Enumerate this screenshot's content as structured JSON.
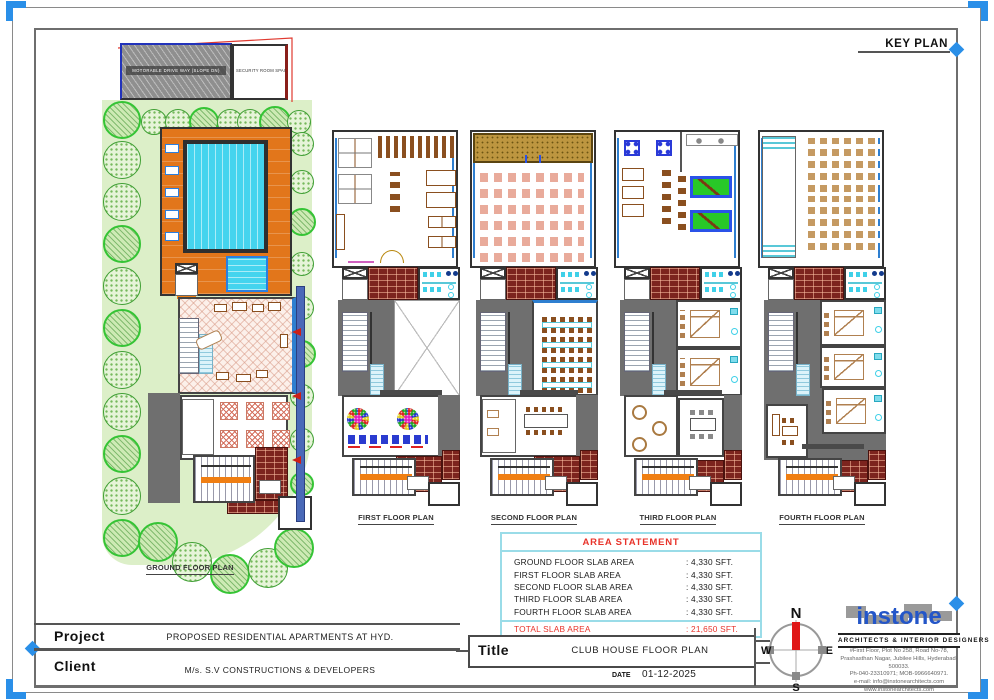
{
  "sheet": {
    "key_plan_label": "KEY PLAN"
  },
  "plans": {
    "ground": {
      "label": "GROUND FLOOR PLAN",
      "hatch_block_label": "MOTORABLE DRIVE WAY (SLOPE DN)",
      "security_room_label": "SECURITY ROOM SPACE"
    },
    "first": {
      "label": "FIRST FLOOR PLAN"
    },
    "second": {
      "label": "SECOND FLOOR PLAN"
    },
    "third": {
      "label": "THIRD FLOOR PLAN"
    },
    "fourth": {
      "label": "FOURTH FLOOR PLAN"
    }
  },
  "area_statement": {
    "title": "AREA STATEMENT",
    "rows": [
      {
        "label": "GROUND FLOOR SLAB AREA",
        "value": ": 4,330 SFT."
      },
      {
        "label": "FIRST FLOOR SLAB AREA",
        "value": ": 4,330 SFT."
      },
      {
        "label": "SECOND FLOOR SLAB AREA",
        "value": ": 4,330 SFT."
      },
      {
        "label": "THIRD FLOOR SLAB AREA",
        "value": ": 4,330 SFT."
      },
      {
        "label": "FOURTH FLOOR SLAB AREA",
        "value": ": 4,330 SFT."
      }
    ],
    "total": {
      "label": "TOTAL SLAB AREA",
      "value": ": 21,650 SFT."
    }
  },
  "title_block": {
    "project_label": "Project",
    "project_value": "PROPOSED RESIDENTIAL APARTMENTS AT HYD.",
    "client_label": "Client",
    "client_value": "M/s. S.V CONSTRUCTIONS & DEVELOPERS",
    "title_label": "Title",
    "title_value": "CLUB HOUSE FLOOR PLAN",
    "date_label": "DATE",
    "date_value": "01-12-2025"
  },
  "compass": {
    "north": "N",
    "south": "S",
    "east": "E",
    "west": "W"
  },
  "firm": {
    "name": "instone",
    "tagline": "ARCHITECTS & INTERIOR DESIGNERS",
    "address_lines": [
      "#First Floor, Plot No 258, Road No-78,",
      "Prashasthan Nagar, Jubilee Hills, Hyderabad-500033.",
      "Ph-040-23310971; MOB-9966640971.",
      "e-mail: info@instonearchitects.com",
      "www.instonearchitects.com"
    ]
  }
}
